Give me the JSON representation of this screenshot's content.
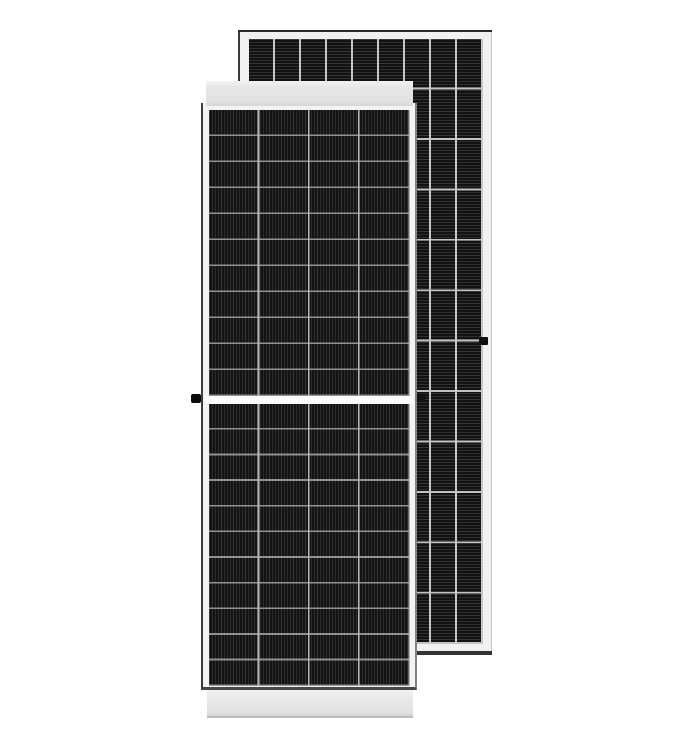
{
  "meta": {
    "title": "Product render of two framed black monocrystalline solar panels standing upright on a white background, front panel overlapping the rear panel",
    "background_color": "#ffffff",
    "visible_text": "none"
  },
  "colors": {
    "cell_base": "#121212",
    "cell_stripe": "#2d2d2d",
    "frame_light": "#f2f2f2",
    "rail_light": "#e4e4e4",
    "edge_dark": "#2e2e2e",
    "grid_line_front_column": "#b7b7b7",
    "grid_line_front_row": "#929292",
    "grid_line_back": "#c6c6c6"
  },
  "panels": {
    "back": {
      "label": "rear solar panel, portrait, horizontal busbar texture, 9 columns x 12 rows of cells",
      "top_edge": {
        "x": 238,
        "y": 30,
        "w": 254,
        "h": 3,
        "color": "#2a2a2a"
      },
      "frame": {
        "x": 238,
        "y": 32,
        "w": 254,
        "h": 620,
        "color": "#f1f1f1"
      },
      "cells": {
        "x": 249,
        "y": 39,
        "w": 234,
        "h": 605,
        "cols": 9,
        "rows": 12,
        "stripes": "horizontal",
        "base": "#121212",
        "stripe": "#2e2e2e",
        "col_line": "#c6c6c6",
        "row_line": "#c2c2c2",
        "line_w": 1.8
      },
      "bottom_edge": {
        "x": 240,
        "y": 651,
        "w": 252,
        "h": 4,
        "color": "#333333"
      },
      "frame_clip": {
        "x": 479,
        "y": 337,
        "w": 9,
        "h": 8,
        "color": "#101010"
      }
    },
    "front": {
      "label": "front solar panel, portrait, vertical busbar texture, 4 columns x 22 half-cut cell rows with white center split",
      "frame": {
        "x": 201,
        "y": 103,
        "w": 216,
        "h": 587,
        "color": "#f3f3f3"
      },
      "top_rail": {
        "x": 206,
        "y": 81,
        "w": 207,
        "h": 25,
        "color": "#e4e4e4"
      },
      "cells_upper": {
        "x": 209,
        "y": 110,
        "w": 201,
        "h": 286,
        "cols": 4,
        "rows": 11,
        "stripes": "vertical",
        "base": "#131313",
        "stripe": "#2c2c2c",
        "col_line": "#b7b7b7",
        "row_line": "#929292",
        "line_w": 1.7
      },
      "center_gap": {
        "x": 205,
        "y": 396,
        "w": 208,
        "h": 8,
        "color": "#fbfbfb"
      },
      "cells_lower": {
        "x": 209,
        "y": 404,
        "w": 201,
        "h": 282,
        "cols": 4,
        "rows": 11,
        "stripes": "vertical",
        "base": "#131313",
        "stripe": "#2c2c2c",
        "col_line": "#b7b7b7",
        "row_line": "#929292",
        "line_w": 1.7
      },
      "grounding_knob": {
        "x": 191,
        "y": 394,
        "w": 10,
        "h": 9,
        "color": "#0c0c0c"
      },
      "side_clip": {
        "x": 417,
        "y": 395,
        "w": 8,
        "h": 7,
        "color": "#141414"
      },
      "bottom_rail": {
        "x": 207,
        "y": 690,
        "w": 206,
        "h": 28,
        "color": "#e6e6e6"
      }
    }
  }
}
